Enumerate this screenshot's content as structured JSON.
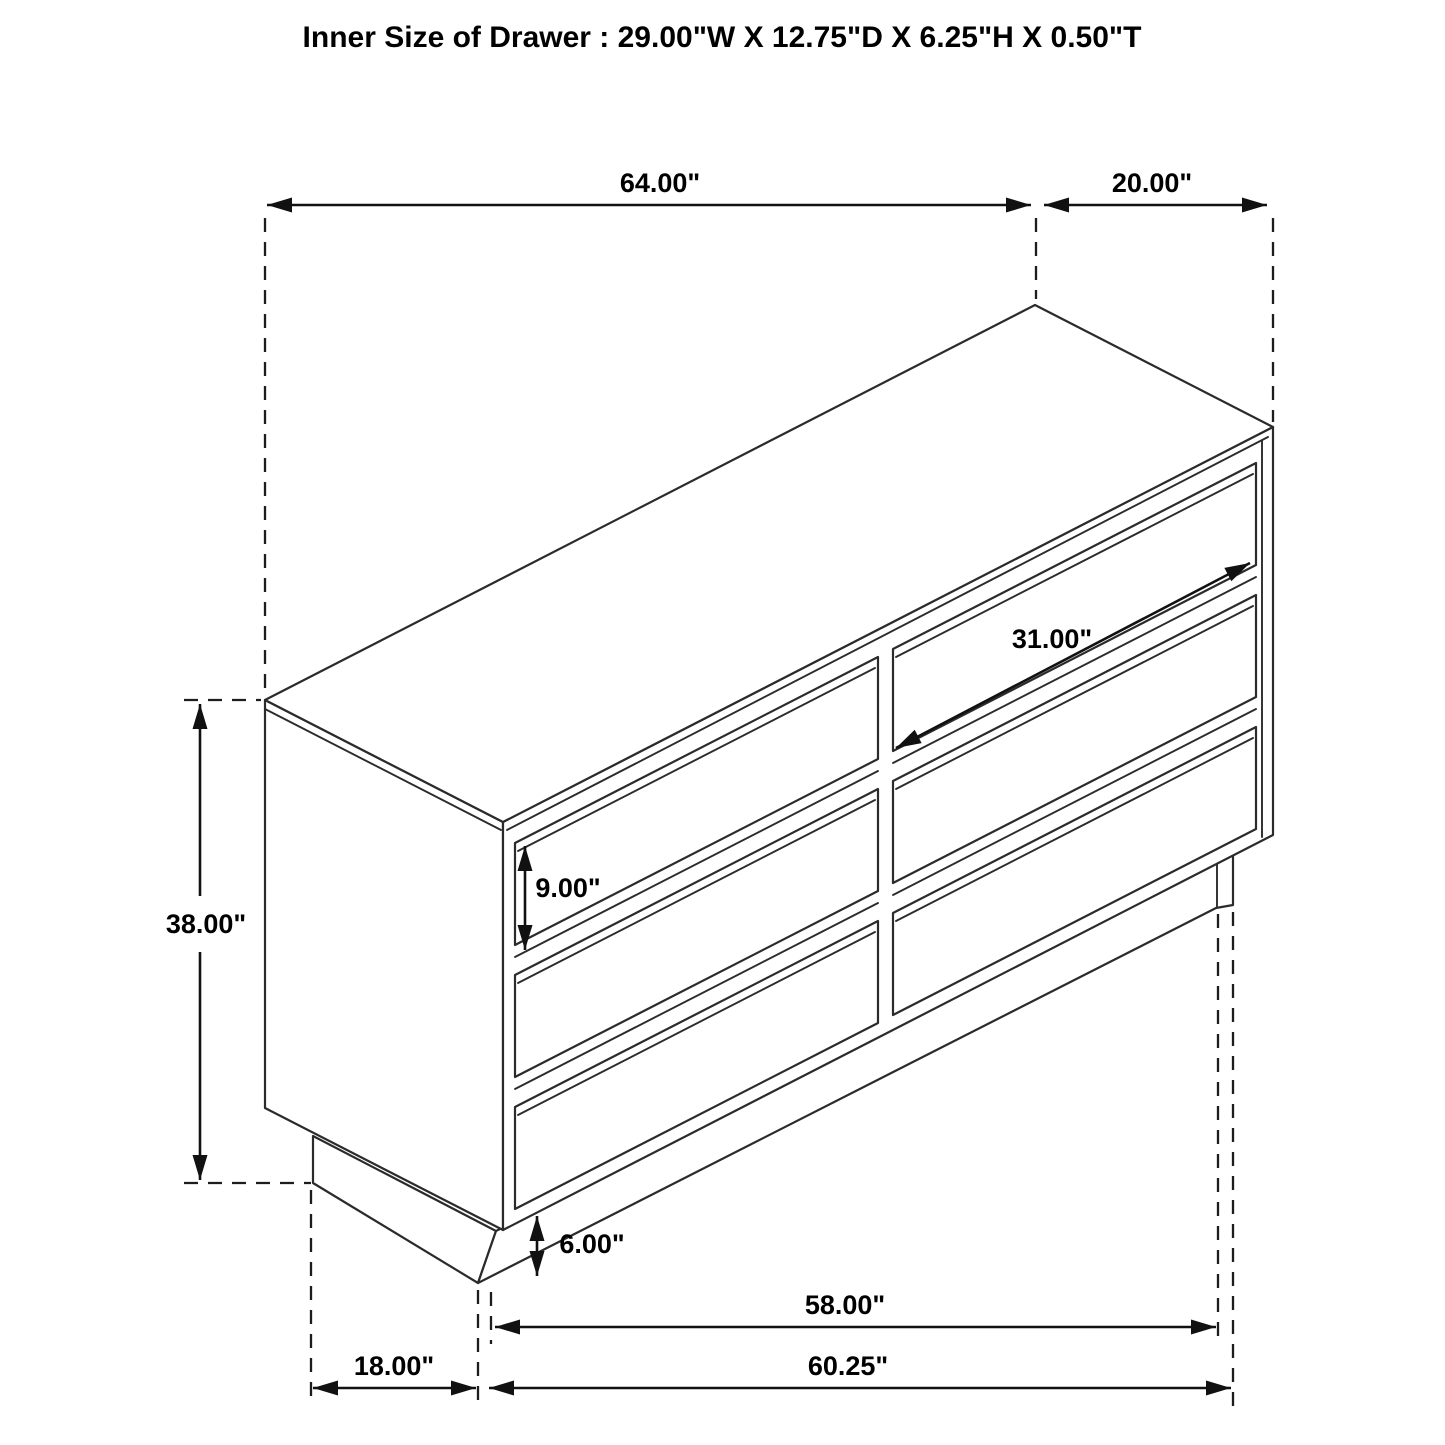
{
  "title": "Inner Size of Drawer : 29.00\"W X 12.75\"D X 6.25\"H X 0.50\"T",
  "diagram": {
    "type": "isometric furniture dimension drawing",
    "object": "six-drawer dresser (2 columns x 3 rows) on recessed base",
    "colors": {
      "line": "#2b2b2b",
      "dimension": "#111111",
      "background": "#ffffff",
      "text": "#000000"
    }
  },
  "dimensions": {
    "top_width": "64.00\"",
    "top_depth": "20.00\"",
    "overall_height": "38.00\"",
    "drawer_width": "31.00\"",
    "drawer_height": "9.00\"",
    "leg_height": "6.00\"",
    "base_front_width": "58.00\"",
    "base_overall_width": "60.25\"",
    "base_side_depth": "18.00\""
  },
  "inner_drawer_size": {
    "width": "29.00\"",
    "depth": "12.75\"",
    "height": "6.25\"",
    "thickness": "0.50\""
  }
}
